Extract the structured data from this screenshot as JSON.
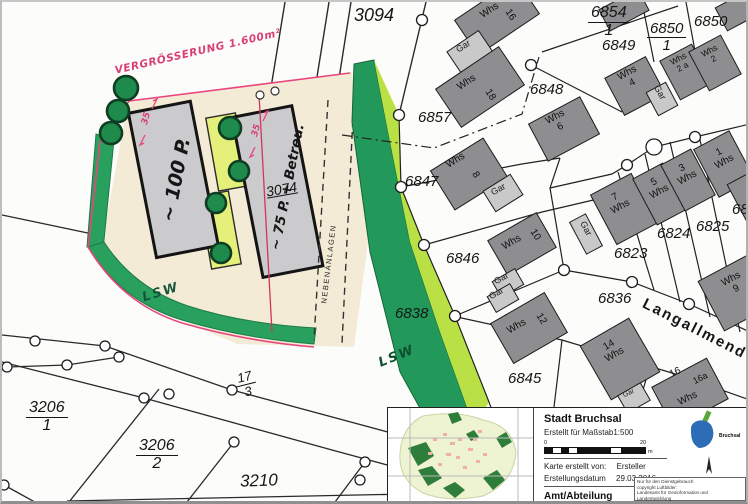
{
  "map": {
    "street_name": "Langallmend",
    "road_parcel": "3094",
    "parcels": {
      "p6854": {
        "num": "6854",
        "den": "1"
      },
      "p6850a": {
        "num": "6850",
        "den": "1"
      },
      "p6850b": {
        "num": "6850"
      },
      "p6849": {
        "num": "6849"
      },
      "p6848": {
        "num": "6848"
      },
      "p6857": {
        "num": "6857"
      },
      "p6847": {
        "num": "6847"
      },
      "p6846": {
        "num": "6846"
      },
      "p6838": {
        "num": "6838"
      },
      "p6845": {
        "num": "6845"
      },
      "p6823": {
        "num": "6823"
      },
      "p6824": {
        "num": "6824"
      },
      "p6825": {
        "num": "6825"
      },
      "p68xx": {
        "num": "68"
      },
      "p6836": {
        "num": "6836"
      },
      "p3074": {
        "num": "3074"
      },
      "p17": {
        "num": "17",
        "den": "3"
      },
      "p3206a": {
        "num": "3206",
        "den": "1"
      },
      "p3206b": {
        "num": "3206",
        "den": "2"
      },
      "p3210": {
        "num": "3210"
      }
    },
    "labels": {
      "house": "Whs",
      "garage": "Gar"
    },
    "house_numbers": {
      "n16": "16",
      "n18": "18",
      "n4": "4",
      "n2a": "2 a",
      "n2": "2",
      "n6": "6",
      "n8": "8",
      "n7": "7",
      "n5": "5",
      "n3": "3",
      "n1": "1",
      "n10": "10",
      "n12": "12",
      "n14": "14",
      "n16b": "16",
      "n16a": "16a",
      "n9": "9"
    }
  },
  "sketch": {
    "enlargement_note": "VERGRÖSSERUNG 1.600m²",
    "parking_left": "~ 100 P.",
    "parking_right": "~ 75 P. + Betreu.",
    "dim_left": "35",
    "dim_right": "35",
    "side_strip": "NEBENANLAGEN",
    "noise_wall_1": "LSW",
    "noise_wall_2": "LSW"
  },
  "titleblock": {
    "city": "Stadt Bruchsal",
    "scale_note": "Erstellt für Maßstab1:500",
    "scale_start": "0",
    "scale_end": "20",
    "scale_unit": "m",
    "created_by_label": "Karte erstellt von:",
    "created_by_value": "Ersteller",
    "date_label": "Erstellungsdatum",
    "date_value": "29.03.2016",
    "department_label": "Amt/Abteilung",
    "logo_caption": "Bruchsal",
    "disclaimer": {
      "l1": "Nur für den Dienstgebrauch",
      "l2": "copyright Luftbilder:",
      "l3": "Landesamt für Geoinformation und Landentwicklung",
      "l4": "Baden-Württemberg"
    }
  },
  "colors": {
    "marker_green_dark": "#2aa05f",
    "marker_green_light": "#b9e145",
    "marker_yellow": "#e4f07a",
    "annotation_pink": "#e8457d",
    "house_gray": "#8e8e90",
    "garage_gray": "#c9c9c9",
    "logo_blue": "#2d6db5",
    "logo_green": "#5aa53c"
  }
}
